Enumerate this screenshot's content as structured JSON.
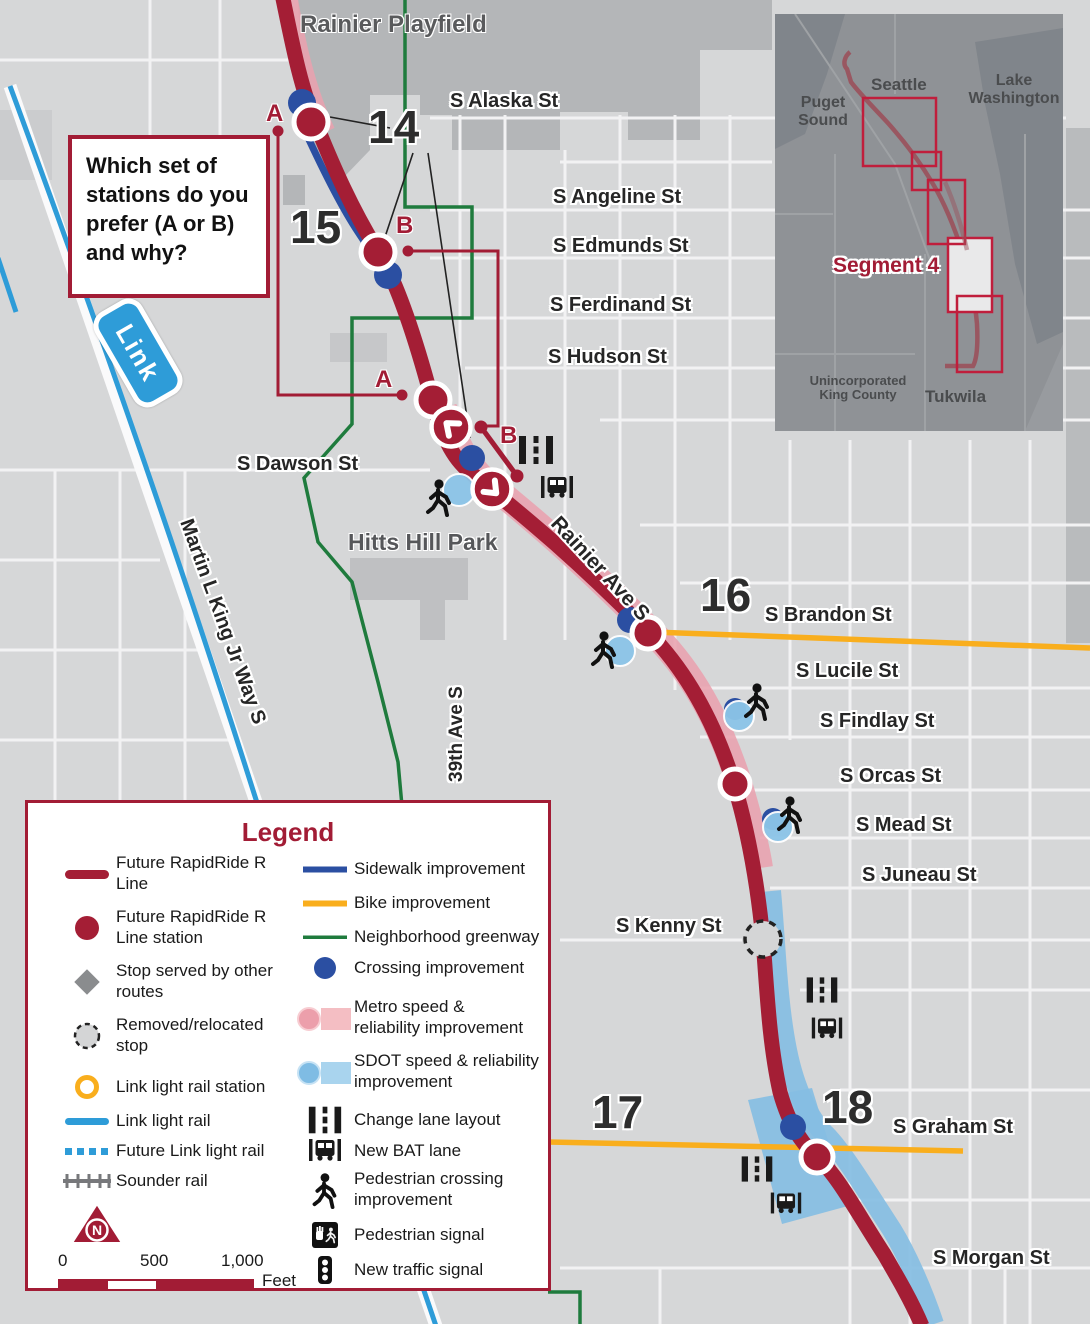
{
  "question_box": {
    "text": "Which set of stations do you prefer (A or B) and why?"
  },
  "map": {
    "streets": {
      "alaska": "S Alaska St",
      "angeline": "S Angeline St",
      "edmunds": "S Edmunds St",
      "ferdinand": "S Ferdinand St",
      "hudson": "S Hudson St",
      "dawson": "S Dawson St",
      "brandon": "S Brandon St",
      "lucile": "S Lucile St",
      "findlay": "S Findlay St",
      "orcas": "S Orcas St",
      "mead": "S Mead St",
      "juneau": "S Juneau St",
      "kenny": "S Kenny St",
      "graham": "S Graham St",
      "morgan": "S Morgan St",
      "rainier_ave": "Rainier Ave S",
      "mlk": "Martin L King Jr Way S",
      "ave39": "39th Ave S"
    },
    "places": {
      "rainier_playfield": "Rainier Playfield",
      "hitts": "Hitts Hill Park"
    },
    "numbers": {
      "n14": "14",
      "n15": "15",
      "n16": "16",
      "n17": "17",
      "n18": "18"
    },
    "options": {
      "a": "A",
      "b": "B"
    },
    "link_badge": "Link"
  },
  "inset": {
    "puget_sound": "Puget Sound",
    "seattle": "Seattle",
    "lake_washington": "Lake Washington",
    "segment_label": "Segment 4",
    "king_county": "Unincorporated King County",
    "tukwila": "Tukwila"
  },
  "legend": {
    "title": "Legend",
    "north": "N",
    "left": [
      {
        "label": "Future RapidRide R Line"
      },
      {
        "label": "Future RapidRide R Line station"
      },
      {
        "label": "Stop served by other routes"
      },
      {
        "label": "Removed/relocated stop"
      },
      {
        "label": "Link light rail station"
      },
      {
        "label": "Link light rail"
      },
      {
        "label": "Future Link light rail"
      },
      {
        "label": "Sounder rail"
      }
    ],
    "right": [
      {
        "label": "Sidewalk improvement"
      },
      {
        "label": "Bike improvement"
      },
      {
        "label": "Neighborhood greenway"
      },
      {
        "label": "Crossing improvement"
      },
      {
        "label": "Metro speed & reliability improvement"
      },
      {
        "label": "SDOT speed & reliability improvement"
      },
      {
        "label": "Change lane layout"
      },
      {
        "label": "New BAT lane"
      },
      {
        "label": "Pedestrian crossing improvement"
      },
      {
        "label": "Pedestrian signal"
      },
      {
        "label": "New traffic signal"
      }
    ],
    "scale": {
      "zero": "0",
      "five_hundred": "500",
      "one_thousand": "1,000",
      "unit": "Feet"
    }
  },
  "colors": {
    "route_red": "#A41E35",
    "callout_red": "#A21C35",
    "pink": "#E9A2AE",
    "sdot_blue": "#85BEE3",
    "crossing_blue": "#2B4FA2",
    "link_blue": "#2E9CD8",
    "bike_yellow": "#F9AE1D",
    "greenway_green": "#1F7B3D",
    "map_bg": "#D6D7D8"
  }
}
